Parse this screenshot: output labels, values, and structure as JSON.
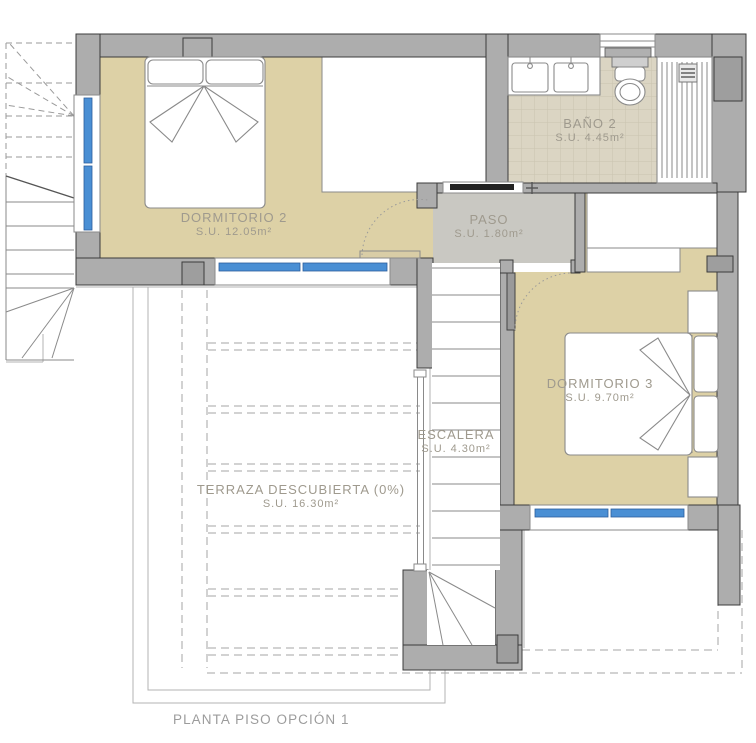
{
  "caption": "PLANTA PISO OPCIÓN 1",
  "rooms": {
    "dormitorio2": {
      "name": "DORMITORIO 2",
      "area": "S.U. 12.05m²"
    },
    "bano2": {
      "name": "BAÑO 2",
      "area": "S.U. 4.45m²"
    },
    "paso": {
      "name": "PASO",
      "area": "S.U. 1.80m²"
    },
    "dormitorio3": {
      "name": "DORMITORIO 3",
      "area": "S.U. 9.70m²"
    },
    "escalera": {
      "name": "ESCALERA",
      "area": "S.U. 4.30m²"
    },
    "terraza": {
      "name": "TERRAZA DESCUBIERTA (0%)",
      "area": "S.U. 16.30m²"
    }
  },
  "colors": {
    "floor_bedroom": "#ddd1a6",
    "floor_bath_tile": "#dbd5c3",
    "floor_hall": "#c9c8c2",
    "wall": "#adadad",
    "wall_dark": "#9e9e9e",
    "window_blue": "#4a8fd4",
    "drawing_line": "#8a8a8a",
    "label_text": "#9f9a8e",
    "caption_text": "#9c9c9c"
  }
}
